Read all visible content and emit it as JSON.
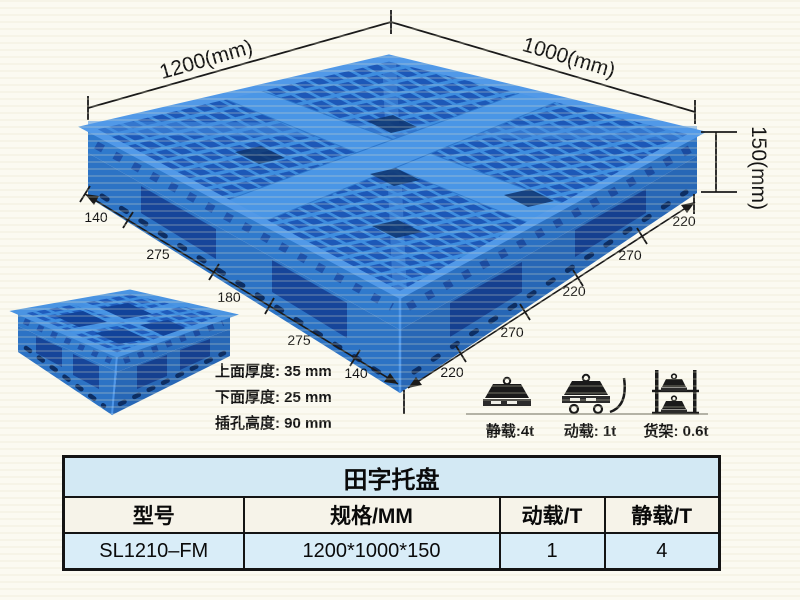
{
  "diagram": {
    "top_length": "1200(mm)",
    "top_width": "1000(mm)",
    "side_height": "150(mm)",
    "left_chain": [
      "140",
      "275",
      "180",
      "275",
      "140"
    ],
    "right_chain": [
      "220",
      "270",
      "220",
      "270",
      "220"
    ],
    "thickness_notes": [
      "上面厚度: 35 mm",
      "下面厚度: 25 mm",
      "插孔高度: 90 mm"
    ],
    "load_icons": [
      {
        "name": "static-load-icon",
        "caption": "静载:4t"
      },
      {
        "name": "dynamic-load-icon",
        "caption": "动载: 1t"
      },
      {
        "name": "rack-load-icon",
        "caption": "货架: 0.6t"
      }
    ]
  },
  "spec_table": {
    "title": "田字托盘",
    "headers": [
      "型号",
      "规格/MM",
      "动载/T",
      "静载/T"
    ],
    "row": [
      "SL1210–FM",
      "1200*1000*150",
      "1",
      "4"
    ]
  },
  "colors": {
    "pallet_rib": "#3e8ddf",
    "pallet_hole": "#1c58b8",
    "pallet_side": "#2f7acd",
    "pallet_recess": "#16459a",
    "dimension_line": "#1a1a1a",
    "table_border": "#141414",
    "table_title_bg": "#d3e9f4",
    "table_header_bg": "#f6f3e9",
    "table_row_bg": "#d9edf8",
    "page_bg": "#fbfaf1"
  }
}
